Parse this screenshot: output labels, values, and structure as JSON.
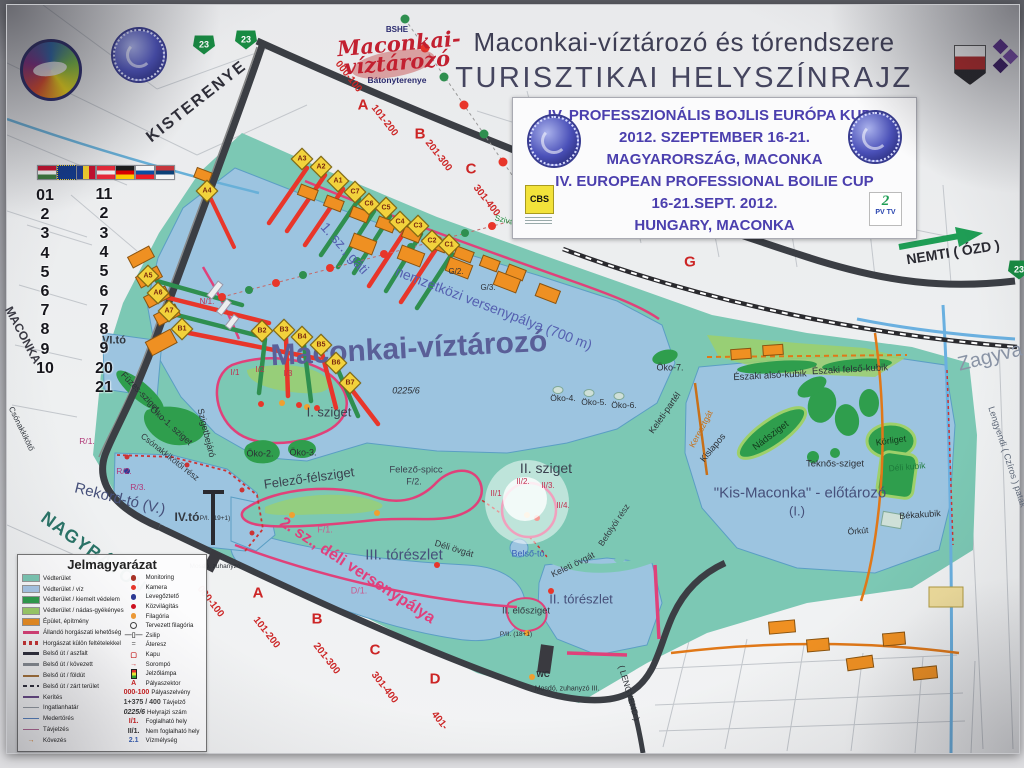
{
  "header": {
    "org": "BSHE",
    "logo_line1": "Maconkai-",
    "logo_line2": "víztározó",
    "logo_subtitle": "Bátonyterenye",
    "title_line1": "Maconkai-víztározó és tórendszere",
    "title_line2": "TURISZTIKAI HELYSZÍNRAJZ"
  },
  "event_box": {
    "lines": [
      "IV. PROFESSZIONÁLIS BOJLIS EURÓPA KUPA",
      "2012. SZEPTEMBER 16-21.",
      "MAGYARORSZÁG, MACONKA",
      "IV. EUROPEAN PROFESSIONAL BOILIE CUP",
      "16-21.SEPT. 2012.",
      "HUNGARY, MACONKA"
    ],
    "sponsor_left": "CBS",
    "sponsor_right_top": "2",
    "sponsor_right": "PV TV"
  },
  "legend": {
    "title": "Jelmagyarázat",
    "left": [
      {
        "sw": "rect",
        "c": "#7cc8b4",
        "t": "Védterület"
      },
      {
        "sw": "rect",
        "c": "#a9c8e8",
        "t": "Védterület / víz"
      },
      {
        "sw": "rect",
        "c": "#2f9e4d",
        "t": "Védterület / kiemelt védelem"
      },
      {
        "sw": "rect",
        "c": "#9ed06a",
        "t": "Védterület / nádas-gyékényes"
      },
      {
        "sw": "rect",
        "c": "#ef9022",
        "t": "Épület, építmény"
      },
      {
        "sw": "line",
        "c": "#e0417a",
        "w": 3,
        "t": "Állandó horgászati lehetőség"
      },
      {
        "sw": "dash",
        "c": "#cc3333",
        "t": "Horgászat külön feltételekkel"
      },
      {
        "sw": "line",
        "c": "#2e2e3c",
        "w": 3,
        "t": "Belső út / aszfalt"
      },
      {
        "sw": "line",
        "c": "#8a8f96",
        "w": 3,
        "t": "Belső út / kövezett"
      },
      {
        "sw": "line",
        "c": "#a8743a",
        "w": 2,
        "t": "Belső út / földút"
      },
      {
        "sw": "dashline",
        "c": "#2e2e3c",
        "t": "Belső út / zárt terület"
      },
      {
        "sw": "line",
        "c": "#6a4a8a",
        "w": 1.5,
        "t": "Kerítés"
      },
      {
        "sw": "line",
        "c": "#9aa0a8",
        "w": 1,
        "t": "Ingatlanhatár"
      },
      {
        "sw": "line",
        "c": "#5a87c8",
        "w": 1,
        "t": "Medertörés"
      },
      {
        "sw": "line",
        "c": "#b86a9a",
        "w": 1,
        "t": "Távjelzés"
      },
      {
        "sw": "arrow",
        "c": "#e07818",
        "t": "Kövezés"
      }
    ],
    "right": [
      {
        "sw": "dot",
        "c": "#a83226",
        "t": "Monitoring"
      },
      {
        "sw": "dot",
        "c": "#e8362a",
        "t": "Kamera"
      },
      {
        "sw": "dot",
        "c": "#2c3a96",
        "t": "Levegőztető"
      },
      {
        "sw": "dot",
        "c": "#d01020",
        "t": "Közvilágítás"
      },
      {
        "sw": "dot",
        "c": "#f09c38",
        "t": "Filagória"
      },
      {
        "sw": "ring",
        "c": "#3a3a3a",
        "t": "Tervezett filagória"
      },
      {
        "sw": "sym",
        "c": "#555",
        "x": "—▯—",
        "t": "Zsilip"
      },
      {
        "sw": "sym",
        "c": "#888",
        "x": "=",
        "t": "Áteresz"
      },
      {
        "sw": "sym",
        "c": "#cc2222",
        "x": "▢",
        "t": "Kapu"
      },
      {
        "sw": "sym",
        "c": "#cc2222",
        "x": "→",
        "t": "Sorompó"
      },
      {
        "sw": "lampa",
        "c": "#222",
        "t": "Jelzőlámpa"
      },
      {
        "sw": "txt",
        "c": "#cc2222",
        "x": "A",
        "t": "Pályaszektor"
      },
      {
        "sw": "txt",
        "c": "#cc2222",
        "x": "000-100",
        "t": "Pályaszelvény"
      },
      {
        "sw": "txt",
        "c": "#444",
        "x": "1+375 / 400",
        "t": "Távjelző"
      },
      {
        "sw": "txt",
        "c": "#333",
        "x": "0225/6",
        "i": 1,
        "t": "Helyrajzi szám"
      },
      {
        "sw": "txt",
        "c": "#cc2222",
        "x": "I/1.",
        "t": "Foglalható hely"
      },
      {
        "sw": "txt",
        "c": "#333",
        "x": "II/1.",
        "t": "Nem foglalható hely"
      },
      {
        "sw": "txt",
        "c": "#3a62b8",
        "x": "2.1",
        "t": "Vízmélység"
      }
    ]
  },
  "map": {
    "shield_label": "23",
    "road_shields": [
      {
        "x": 197,
        "y": 40
      },
      {
        "x": 239,
        "y": 35
      },
      {
        "x": 1012,
        "y": 265
      }
    ],
    "row_numbers_left": [
      "01",
      "2",
      "3",
      "4",
      "5",
      "6",
      "7",
      "8",
      "9",
      "10"
    ],
    "row_numbers_right": [
      "11",
      "2",
      "3",
      "4",
      "5",
      "6",
      "7",
      "8",
      "9",
      "20",
      "21"
    ],
    "flags": [
      {
        "id": "hu",
        "dir": "h",
        "stripes": [
          "#c8102e",
          "#f5f5f5",
          "#3d7a3f"
        ]
      },
      {
        "id": "eu",
        "eu": 1
      },
      {
        "id": "ro",
        "dir": "v",
        "stripes": [
          "#1b3a8f",
          "#f6d32e",
          "#c8102e"
        ]
      },
      {
        "id": "at",
        "dir": "h",
        "stripes": [
          "#ed2939",
          "#f5f5f5",
          "#ed2939"
        ]
      },
      {
        "id": "de",
        "dir": "h",
        "stripes": [
          "#1a1a1a",
          "#dd0000",
          "#ffce00"
        ]
      },
      {
        "id": "sk",
        "dir": "h",
        "stripes": [
          "#f5f5f5",
          "#0b4ea2",
          "#ee1c25"
        ]
      },
      {
        "id": "rs",
        "dir": "h",
        "stripes": [
          "#c6363c",
          "#0c4076",
          "#f5f5f5"
        ]
      }
    ],
    "pegs": [
      {
        "t": "A1",
        "x": 331,
        "y": 176
      },
      {
        "t": "A2",
        "x": 314,
        "y": 162
      },
      {
        "t": "A3",
        "x": 295,
        "y": 154
      },
      {
        "t": "A4",
        "x": 200,
        "y": 186
      },
      {
        "t": "A5",
        "x": 141,
        "y": 271
      },
      {
        "t": "A6",
        "x": 151,
        "y": 288
      },
      {
        "t": "A7",
        "x": 162,
        "y": 306
      },
      {
        "t": "B1",
        "x": 175,
        "y": 324
      },
      {
        "t": "B2",
        "x": 255,
        "y": 326
      },
      {
        "t": "B3",
        "x": 277,
        "y": 325
      },
      {
        "t": "B4",
        "x": 295,
        "y": 332
      },
      {
        "t": "B5",
        "x": 314,
        "y": 340
      },
      {
        "t": "B6",
        "x": 329,
        "y": 358
      },
      {
        "t": "B7",
        "x": 343,
        "y": 378
      },
      {
        "t": "C1",
        "x": 442,
        "y": 240
      },
      {
        "t": "C2",
        "x": 425,
        "y": 236
      },
      {
        "t": "C3",
        "x": 411,
        "y": 221
      },
      {
        "t": "C4",
        "x": 393,
        "y": 217
      },
      {
        "t": "C5",
        "x": 379,
        "y": 203
      },
      {
        "t": "C6",
        "x": 362,
        "y": 199
      },
      {
        "t": "C7",
        "x": 348,
        "y": 187
      }
    ],
    "labels": [
      {
        "t": "KISTERENYE",
        "x": 190,
        "y": 97,
        "r": -38,
        "s": 16,
        "c": "#2e2e38",
        "b": 1,
        "ls": 2
      },
      {
        "t": "NEMTI ( ÓZD )",
        "x": 946,
        "y": 247,
        "r": -9,
        "s": 14,
        "c": "#2a2a32",
        "b": 1
      },
      {
        "t": "Zagyva",
        "x": 983,
        "y": 352,
        "r": -14,
        "s": 20,
        "c": "#8a94a6"
      },
      {
        "t": "Lengyendi ( Czíros ) patak",
        "x": 1000,
        "y": 452,
        "r": 72,
        "s": 9,
        "c": "#5e6878"
      },
      {
        "t": "NAGYBÁTONY",
        "x": 92,
        "y": 551,
        "r": 36,
        "s": 18,
        "c": "#2a7468",
        "b": 1,
        "ls": 1
      },
      {
        "t": "MACONKA",
        "x": 16,
        "y": 330,
        "r": 62,
        "s": 12,
        "c": "#3a3a44",
        "b": 1
      },
      {
        "t": "Maconkai-víztározó",
        "x": 402,
        "y": 344,
        "r": -3,
        "s": 30,
        "c": "#5a5f98",
        "b": 1
      },
      {
        "t": "1. sz., gáti",
        "x": 338,
        "y": 243,
        "r": 48,
        "s": 14,
        "c": "#5560b0"
      },
      {
        "t": "nemzetközi versenypálya (700 m)",
        "x": 487,
        "y": 303,
        "r": 21,
        "s": 14,
        "c": "#5560b0"
      },
      {
        "t": "2. sz., déli versenypálya",
        "x": 350,
        "y": 566,
        "r": 33,
        "s": 16,
        "c": "#e0407c",
        "b": 1
      },
      {
        "t": "I. sziget",
        "x": 322,
        "y": 407,
        "r": 0,
        "s": 13,
        "c": "#3c4250"
      },
      {
        "t": "II. sziget",
        "x": 539,
        "y": 463,
        "r": 0,
        "s": 14,
        "c": "#3c4250"
      },
      {
        "t": "III. tórészlet",
        "x": 397,
        "y": 550,
        "r": 0,
        "s": 15,
        "c": "#46507a"
      },
      {
        "t": "II. tórészlet",
        "x": 574,
        "y": 594,
        "r": 0,
        "s": 13,
        "c": "#46507a"
      },
      {
        "t": "Felező-félsziget",
        "x": 302,
        "y": 473,
        "r": -8,
        "s": 13,
        "c": "#3c4250"
      },
      {
        "t": "Felező-spicc",
        "x": 409,
        "y": 465,
        "r": 0,
        "s": 9.5,
        "c": "#3c4250"
      },
      {
        "t": "F/2.",
        "x": 407,
        "y": 477,
        "r": 0,
        "s": 9,
        "c": "#3c4250"
      },
      {
        "t": "F/1.",
        "x": 318,
        "y": 525,
        "r": 0,
        "s": 9,
        "c": "#c85a8e"
      },
      {
        "t": "D/1.",
        "x": 352,
        "y": 586,
        "r": 0,
        "s": 9,
        "c": "#c85a8e"
      },
      {
        "t": "Déli övgát",
        "x": 447,
        "y": 544,
        "r": 17,
        "s": 9,
        "c": "#33383f"
      },
      {
        "t": "Keleti övgát",
        "x": 566,
        "y": 560,
        "r": -26,
        "s": 9,
        "c": "#33383f"
      },
      {
        "t": "Befolyói rész",
        "x": 607,
        "y": 520,
        "r": -56,
        "s": 8.5,
        "c": "#33383f"
      },
      {
        "t": "Belső-tó",
        "x": 521,
        "y": 549,
        "r": 0,
        "s": 9,
        "c": "#3a62b8"
      },
      {
        "t": "II. elősziget",
        "x": 519,
        "y": 606,
        "r": 0,
        "s": 9.5,
        "c": "#33383f"
      },
      {
        "t": "Rekord-tó (V.)",
        "x": 113,
        "y": 494,
        "r": 14,
        "s": 15,
        "c": "#46507a"
      },
      {
        "t": "IV.tó",
        "x": 180,
        "y": 512,
        "r": 0,
        "s": 12,
        "c": "#33383f",
        "b": 1
      },
      {
        "t": "VI.tó",
        "x": 107,
        "y": 336,
        "r": 0,
        "s": 11,
        "c": "#33383f",
        "b": 1
      },
      {
        "t": "Csónakkikötői rész",
        "x": 163,
        "y": 452,
        "r": 38,
        "s": 8.5,
        "c": "#33383f"
      },
      {
        "t": "Csónakkikötő",
        "x": 14,
        "y": 424,
        "r": 64,
        "s": 8,
        "c": "#33383f"
      },
      {
        "t": "R/1.",
        "x": 80,
        "y": 436,
        "r": 0,
        "s": 8.5,
        "c": "#b03878"
      },
      {
        "t": "R/2.",
        "x": 117,
        "y": 466,
        "r": 0,
        "s": 8.5,
        "c": "#b03878"
      },
      {
        "t": "R/3.",
        "x": 131,
        "y": 482,
        "r": 0,
        "s": 8.5,
        "c": "#b03878"
      },
      {
        "t": "Füzes-sziget",
        "x": 133,
        "y": 387,
        "r": 46,
        "s": 9,
        "c": "#2c3036"
      },
      {
        "t": "Öko-1. sziget",
        "x": 164,
        "y": 421,
        "r": 42,
        "s": 9,
        "c": "#2c3036"
      },
      {
        "t": "Sziget­bejáró",
        "x": 199,
        "y": 428,
        "r": 76,
        "s": 9,
        "c": "#2c3036"
      },
      {
        "t": "Öko-2.",
        "x": 253,
        "y": 449,
        "r": 0,
        "s": 9,
        "c": "#2c3036"
      },
      {
        "t": "Öko-3.",
        "x": 296,
        "y": 448,
        "r": 0,
        "s": 9,
        "c": "#2c3036"
      },
      {
        "t": "Öko-4.",
        "x": 556,
        "y": 393,
        "r": 0,
        "s": 8.5,
        "c": "#2c3036"
      },
      {
        "t": "Öko-5.",
        "x": 587,
        "y": 397,
        "r": 0,
        "s": 8.5,
        "c": "#2c3036"
      },
      {
        "t": "Öko-6.",
        "x": 617,
        "y": 400,
        "r": 0,
        "s": 8.5,
        "c": "#2c3036"
      },
      {
        "t": "Öko-7.",
        "x": 663,
        "y": 363,
        "r": 0,
        "s": 9,
        "c": "#2c3036"
      },
      {
        "t": "0225/6",
        "x": 399,
        "y": 386,
        "r": 0,
        "s": 9,
        "c": "#2c3036",
        "i": 1
      },
      {
        "t": "Keleti-partél",
        "x": 658,
        "y": 408,
        "r": -55,
        "s": 9,
        "c": "#2c3036"
      },
      {
        "t": "Keresztgát",
        "x": 694,
        "y": 424,
        "r": -62,
        "s": 8.5,
        "c": "#c87018"
      },
      {
        "t": "Kislapos",
        "x": 706,
        "y": 443,
        "r": -50,
        "s": 9,
        "c": "#2c3036"
      },
      {
        "t": "Északi alsó-kubik",
        "x": 763,
        "y": 371,
        "r": -3,
        "s": 9.5,
        "c": "#2c3036"
      },
      {
        "t": "Északi felső-kubik",
        "x": 843,
        "y": 365,
        "r": -3,
        "s": 9.5,
        "c": "#2c3036"
      },
      {
        "t": "Nádsziget",
        "x": 764,
        "y": 431,
        "r": -37,
        "s": 9.5,
        "c": "#12381c"
      },
      {
        "t": "Körliget",
        "x": 884,
        "y": 436,
        "r": -8,
        "s": 9,
        "c": "#12381c"
      },
      {
        "t": "Teknős-sziget",
        "x": 828,
        "y": 459,
        "r": 0,
        "s": 9.5,
        "c": "#2c3036"
      },
      {
        "t": "Déli kubik",
        "x": 900,
        "y": 462,
        "r": -5,
        "s": 8.5,
        "c": "#1d7a3a"
      },
      {
        "t": "\"Kis-Maconka\" - előtározó",
        "x": 793,
        "y": 488,
        "r": 0,
        "s": 15,
        "c": "#46507a"
      },
      {
        "t": "(I.)",
        "x": 790,
        "y": 506,
        "r": 0,
        "s": 13,
        "c": "#46507a"
      },
      {
        "t": "Békakubik",
        "x": 913,
        "y": 510,
        "r": -4,
        "s": 9,
        "c": "#2c3036"
      },
      {
        "t": "Örkút",
        "x": 851,
        "y": 526,
        "r": -5,
        "s": 8.5,
        "c": "#2c3036"
      },
      {
        "t": "Szivárgó-csatorna",
        "x": 519,
        "y": 221,
        "r": 14,
        "s": 8,
        "c": "#1d8a3a"
      },
      {
        "t": "( LENGYEND )",
        "x": 622,
        "y": 688,
        "r": 74,
        "s": 8.5,
        "c": "#2c3036"
      },
      {
        "t": "G/2.",
        "x": 449,
        "y": 267,
        "r": 0,
        "s": 8,
        "c": "#2c3036"
      },
      {
        "t": "G/3.",
        "x": 481,
        "y": 283,
        "r": 0,
        "s": 8,
        "c": "#2c3036"
      },
      {
        "t": "G",
        "x": 683,
        "y": 257,
        "r": 0,
        "s": 15,
        "c": "#cc2525",
        "b": 1
      },
      {
        "t": "A",
        "x": 356,
        "y": 100,
        "r": 0,
        "s": 15,
        "c": "#cc2525",
        "b": 1
      },
      {
        "t": "B",
        "x": 413,
        "y": 129,
        "r": 0,
        "s": 15,
        "c": "#cc2525",
        "b": 1
      },
      {
        "t": "C",
        "x": 464,
        "y": 164,
        "r": 0,
        "s": 15,
        "c": "#cc2525",
        "b": 1
      },
      {
        "t": "D",
        "x": 511,
        "y": 189,
        "r": 0,
        "s": 15,
        "c": "#cc2525",
        "b": 1
      },
      {
        "t": "000-100",
        "x": 341,
        "y": 72,
        "r": 52,
        "s": 10,
        "c": "#cc2525",
        "b": 1
      },
      {
        "t": "101-200",
        "x": 377,
        "y": 116,
        "r": 52,
        "s": 10,
        "c": "#cc2525",
        "b": 1
      },
      {
        "t": "201-300",
        "x": 431,
        "y": 151,
        "r": 52,
        "s": 10,
        "c": "#cc2525",
        "b": 1
      },
      {
        "t": "301-400",
        "x": 479,
        "y": 196,
        "r": 52,
        "s": 10,
        "c": "#cc2525",
        "b": 1
      },
      {
        "t": "A",
        "x": 251,
        "y": 588,
        "r": 0,
        "s": 15,
        "c": "#cc2525",
        "b": 1
      },
      {
        "t": "B",
        "x": 310,
        "y": 614,
        "r": 0,
        "s": 15,
        "c": "#cc2525",
        "b": 1
      },
      {
        "t": "C",
        "x": 368,
        "y": 645,
        "r": 0,
        "s": 15,
        "c": "#cc2525",
        "b": 1
      },
      {
        "t": "D",
        "x": 428,
        "y": 674,
        "r": 0,
        "s": 15,
        "c": "#cc2525",
        "b": 1
      },
      {
        "t": "000-100",
        "x": 203,
        "y": 597,
        "r": 52,
        "s": 10,
        "c": "#cc2525",
        "b": 1
      },
      {
        "t": "101-200",
        "x": 259,
        "y": 628,
        "r": 52,
        "s": 10,
        "c": "#cc2525",
        "b": 1
      },
      {
        "t": "201-300",
        "x": 319,
        "y": 654,
        "r": 52,
        "s": 10,
        "c": "#cc2525",
        "b": 1
      },
      {
        "t": "301-400",
        "x": 377,
        "y": 683,
        "r": 52,
        "s": 10,
        "c": "#cc2525",
        "b": 1
      },
      {
        "t": "401-",
        "x": 432,
        "y": 716,
        "r": 52,
        "s": 10,
        "c": "#cc2525",
        "b": 1
      },
      {
        "t": "I/1",
        "x": 228,
        "y": 368,
        "r": 0,
        "s": 8,
        "c": "#c03050"
      },
      {
        "t": "I/2",
        "x": 253,
        "y": 365,
        "r": 0,
        "s": 8,
        "c": "#c03050"
      },
      {
        "t": "I/3",
        "x": 281,
        "y": 369,
        "r": 0,
        "s": 8,
        "c": "#c03050"
      },
      {
        "t": "II/1",
        "x": 489,
        "y": 489,
        "r": 0,
        "s": 8,
        "c": "#c03050"
      },
      {
        "t": "II/2.",
        "x": 516,
        "y": 477,
        "r": 0,
        "s": 8,
        "c": "#c03050"
      },
      {
        "t": "II/3.",
        "x": 541,
        "y": 481,
        "r": 0,
        "s": 8,
        "c": "#c03050"
      },
      {
        "t": "II/4.",
        "x": 556,
        "y": 501,
        "r": 0,
        "s": 8,
        "c": "#c03050"
      },
      {
        "t": "N/1.",
        "x": 200,
        "y": 297,
        "r": 0,
        "s": 8,
        "c": "#c03050"
      },
      {
        "t": "WC",
        "x": 536,
        "y": 670,
        "r": 0,
        "s": 8,
        "c": "#2c3036",
        "b": 1
      },
      {
        "t": "Mosdó, zuhanyzó III.",
        "x": 560,
        "y": 684,
        "r": 0,
        "s": 7,
        "c": "#2c3036"
      },
      {
        "t": "P/II. (18+1)",
        "x": 509,
        "y": 630,
        "r": 0,
        "s": 6.5,
        "c": "#2c3036"
      },
      {
        "t": "P/I. (19+1)",
        "x": 208,
        "y": 514,
        "r": 0,
        "s": 6.5,
        "c": "#2c3036"
      },
      {
        "t": "Mosdó, zuhanyzó",
        "x": 208,
        "y": 562,
        "r": 0,
        "s": 6.5,
        "c": "#2c3036"
      }
    ]
  }
}
